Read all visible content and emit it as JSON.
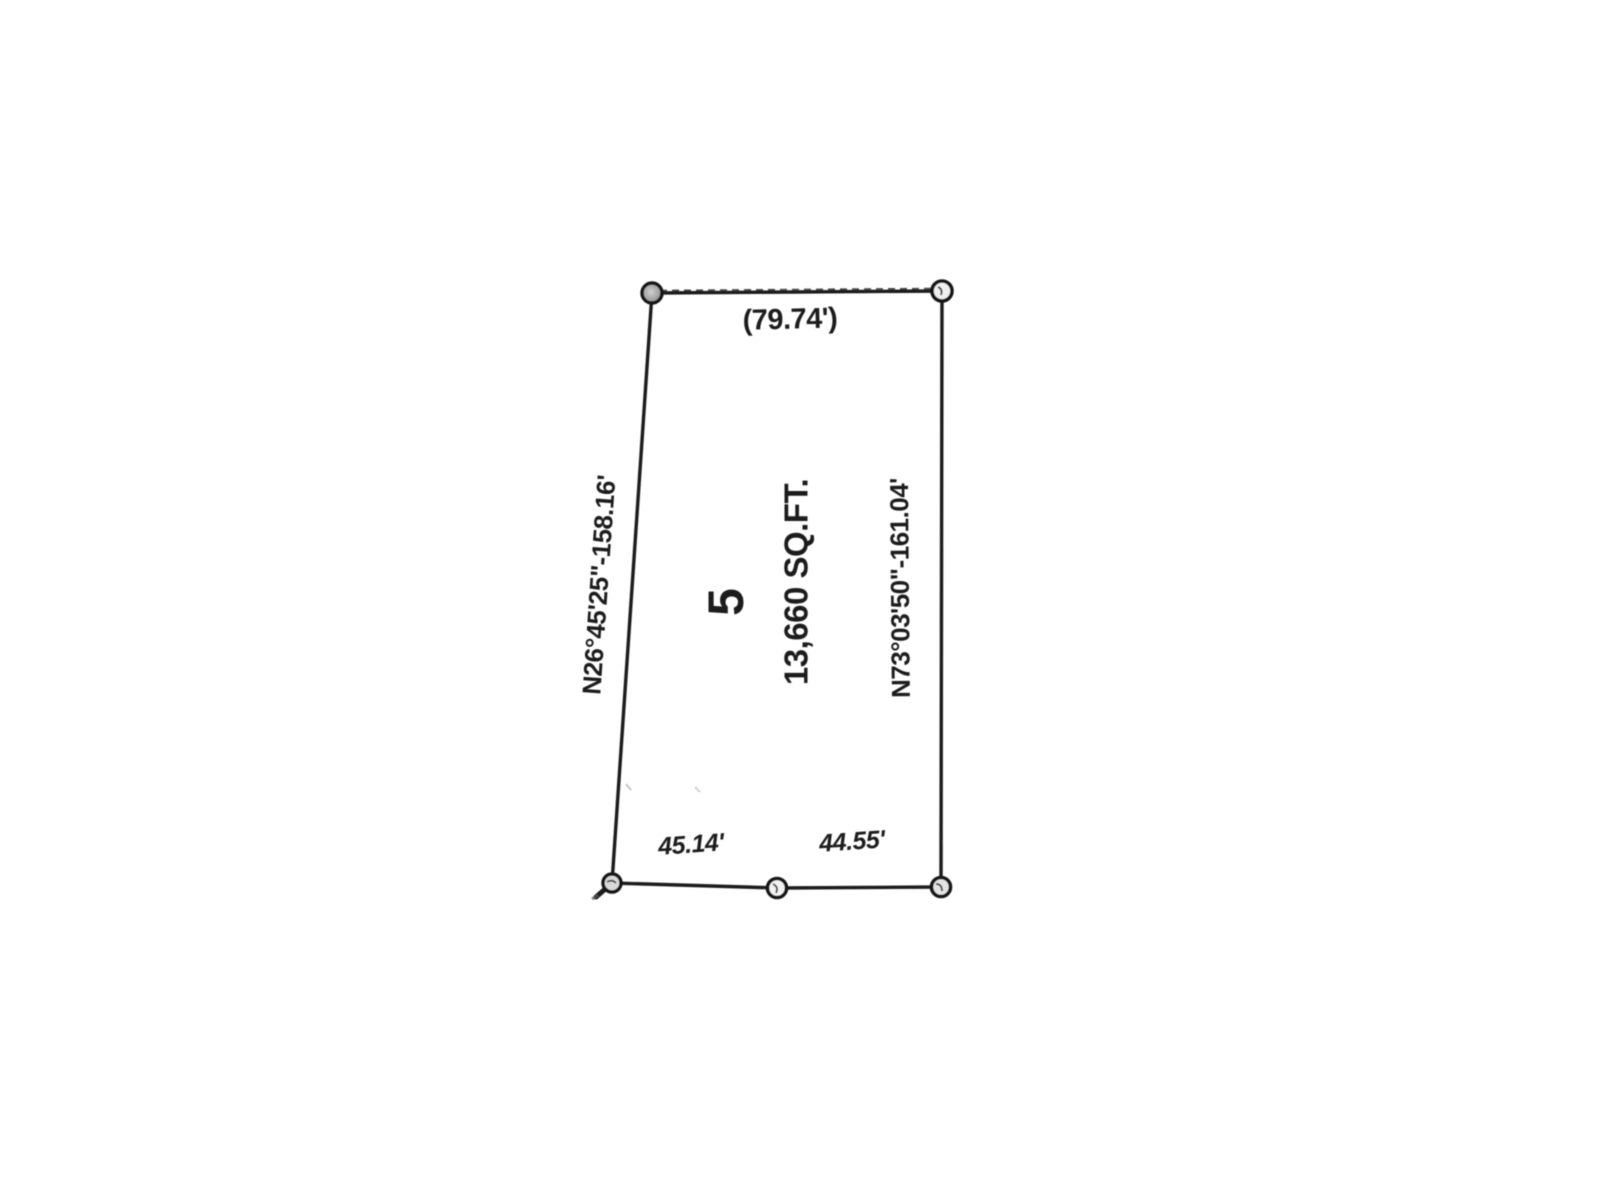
{
  "plat": {
    "lot_number": "5",
    "area_label": "13,660 SQ.FT.",
    "dimensions": {
      "top": "(79.74')",
      "left_bearing": "N26°45'25\"-158.16'",
      "right_bearing": "N73°03'50\"-161.04'",
      "bottom_left": "45.14'",
      "bottom_right": "44.55'"
    },
    "ink_color": "#1c1c1c",
    "paper_color": "#ffffff"
  }
}
